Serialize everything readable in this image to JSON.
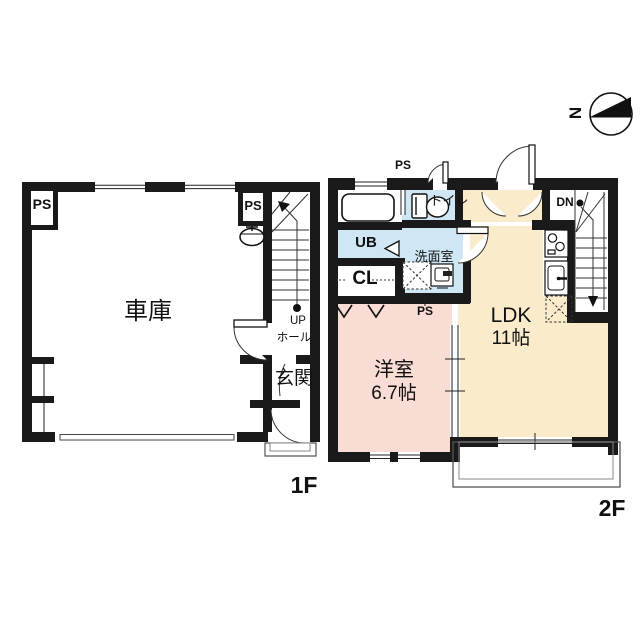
{
  "title": "floor-plan",
  "colors": {
    "wall": "#1a1a1a",
    "wet_rooms": "#cfe7f4",
    "ldk_room": "#faeccb",
    "bedroom_room": "#f9dcd4",
    "line": "#333333"
  },
  "compass": {
    "north": "N"
  },
  "floor1": {
    "label": "1F",
    "garage": "車庫",
    "ps_left": "PS",
    "ps_right": "PS",
    "up": "UP",
    "hall": "ホール",
    "entrance": "玄関"
  },
  "floor2": {
    "label": "2F",
    "ldk": "LDK",
    "ldk_size": "11帖",
    "bedroom": "洋室",
    "bedroom_size": "6.7帖",
    "bath": "UB",
    "closet": "CL",
    "washroom": "洗面室",
    "toilet": "トイレ",
    "ps_top": "PS",
    "ps_bottom": "PS",
    "down": "DN"
  }
}
